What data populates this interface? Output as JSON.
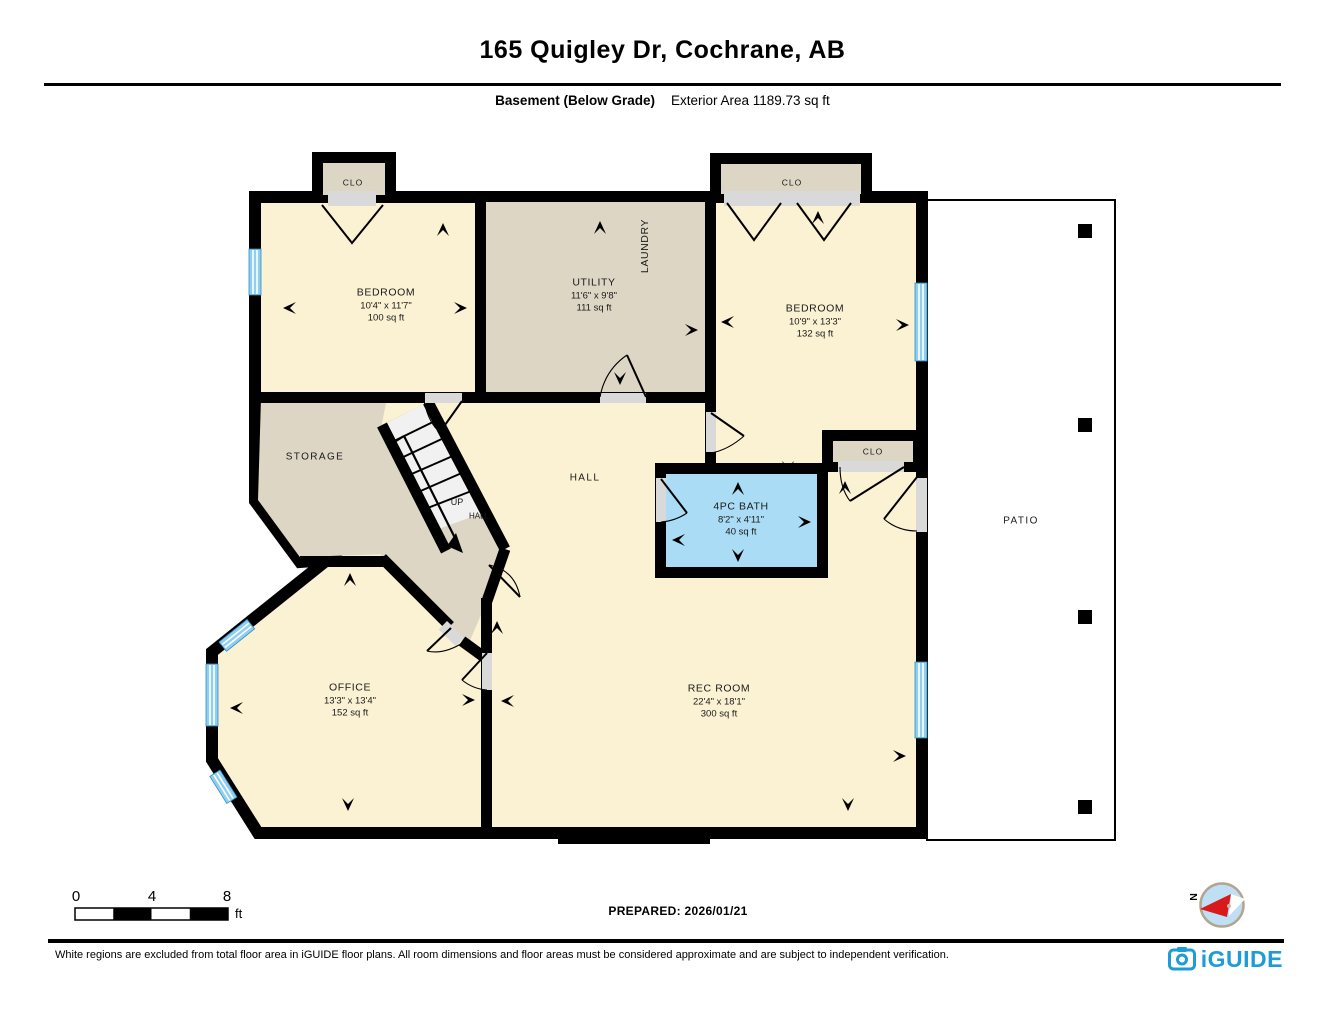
{
  "header": {
    "title": "165 Quigley Dr, Cochrane, AB",
    "floor_label": "Basement (Below Grade)",
    "area_label": "Exterior Area 1189.73 sq ft"
  },
  "rooms": {
    "bedroom1": {
      "name": "BEDROOM",
      "dims": "10'4\" x 11'7\"",
      "area": "100 sq ft"
    },
    "utility": {
      "name": "UTILITY",
      "dims": "11'6\" x 9'8\"",
      "area": "111 sq ft"
    },
    "laundry": {
      "name": "LAUNDRY"
    },
    "bedroom2": {
      "name": "BEDROOM",
      "dims": "10'9\" x 13'3\"",
      "area": "132 sq ft"
    },
    "bath": {
      "name": "4PC BATH",
      "dims": "8'2\" x 4'11\"",
      "area": "40 sq ft"
    },
    "office": {
      "name": "OFFICE",
      "dims": "13'3\" x 13'4\"",
      "area": "152 sq ft"
    },
    "rec_room": {
      "name": "REC ROOM",
      "dims": "22'4\" x 18'1\"",
      "area": "300 sq ft"
    },
    "storage": {
      "name": "STORAGE"
    },
    "hall": {
      "name": "HALL"
    },
    "stair_up": {
      "name": "UP"
    },
    "stair_hall": {
      "name": "HALL"
    },
    "closet1": {
      "name": "CLO"
    },
    "closet2": {
      "name": "CLO"
    },
    "closet3": {
      "name": "CLO"
    },
    "patio": {
      "name": "PATIO"
    }
  },
  "scale_bar": {
    "ticks": [
      "0",
      "4",
      "8"
    ],
    "unit": "ft"
  },
  "prepared_label": "PREPARED: 2026/01/21",
  "compass": {
    "north_label": "N"
  },
  "footer": {
    "disclaimer": "White regions are excluded from total floor area in iGUIDE floor plans. All room dimensions and floor areas must be considered approximate and are subject to independent verification.",
    "brand": "iGUIDE"
  },
  "colors": {
    "room_fill": "#FBF1D3",
    "service_fill": "#DDD6C5",
    "bath_fill": "#ABDCF5",
    "window_blue": "#8FCEEF",
    "threshold_grey": "#D9D9D9",
    "wall": "#000000",
    "brand_blue": "#1E9CD5"
  }
}
